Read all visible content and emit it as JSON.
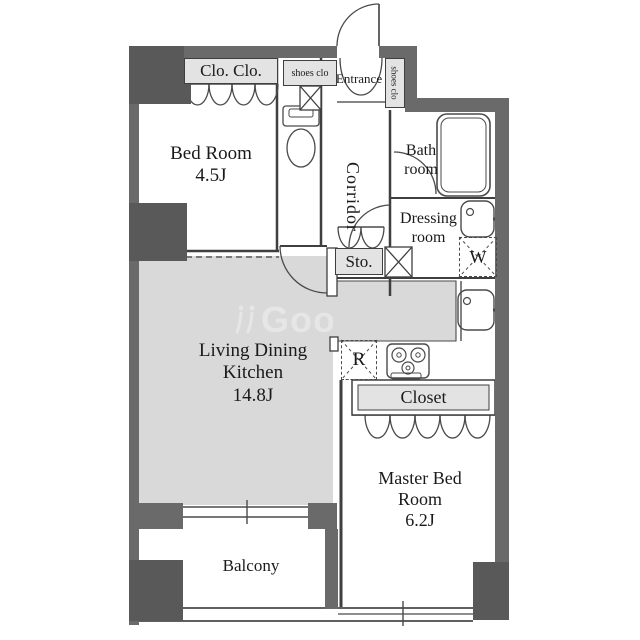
{
  "floorplan": {
    "rooms": {
      "bedroom": {
        "name": "Bed Room",
        "size": "4.5J"
      },
      "ldk": {
        "name1": "Living Dining",
        "name2": "Kitchen",
        "size": "14.8J"
      },
      "master": {
        "name1": "Master Bed",
        "name2": "Room",
        "size": "6.2J"
      },
      "bath": {
        "name1": "Bath",
        "name2": "room"
      },
      "dressing": {
        "name1": "Dressing",
        "name2": "room"
      },
      "corridor": {
        "name": "Corridor"
      },
      "entrance": {
        "name": "Entrance"
      },
      "balcony": {
        "name": "Balcony"
      }
    },
    "fixtures": {
      "double_closet": "Clo. Clo.",
      "shoes_closet_top": "shoes clo",
      "shoes_closet_side": "shoes clo",
      "storage": "Sto.",
      "closet": "Closet",
      "washing_machine": "W",
      "refrigerator": "R"
    },
    "watermark": {
      "text": "GooRooM",
      "icon": "watermark-logo-icon"
    },
    "icons": {
      "toilet": "toilet-icon",
      "bathtub": "bathtub-icon",
      "vanity_sink": "sink-icon",
      "kitchen_sink": "sink-icon",
      "stove": "stove-icon",
      "duct_shafts": "x-box-icon",
      "doors": "door-arc-icon",
      "curtains": "curtain-scallop-icon",
      "windows": "window-lines-icon"
    },
    "colors": {
      "wall": "#6a6a6a",
      "pillar": "#595959",
      "ldk_floor": "#d9d9d9",
      "label_box_bg": "#e3e3e3",
      "line": "#3f3f3f",
      "text": "#1a1a1a",
      "watermark": "#e6e6e6"
    }
  }
}
